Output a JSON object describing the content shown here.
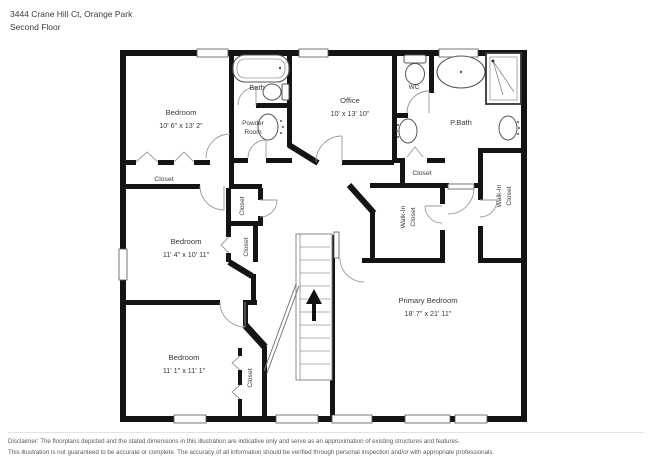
{
  "header": {
    "address": "3444 Crane Hill Ct, Orange Park",
    "floor": "Second Floor"
  },
  "rooms": {
    "bedroom_top": {
      "name": "Bedroom",
      "dims": "10' 6\" x 13' 2\""
    },
    "bedroom_mid": {
      "name": "Bedroom",
      "dims": "11' 4\" x 10' 11\""
    },
    "bedroom_bottom": {
      "name": "Bedroom",
      "dims": "11' 1\" x 11' 1\""
    },
    "primary_bedroom": {
      "name": "Primary Bedroom",
      "dims": "18' 7\" x 21' 11\""
    },
    "office": {
      "name": "Office",
      "dims": "10' x 13' 10\""
    },
    "bath": {
      "name": "Bath"
    },
    "powder_room": {
      "line1": "Powder",
      "line2": "Room"
    },
    "wc": {
      "name": "WC"
    },
    "primary_bath": {
      "name": "P.Bath"
    },
    "closet_label": "Closet",
    "walk_in": {
      "line1": "Walk-In",
      "line2": "Closet"
    }
  },
  "disclaimer": {
    "line1": "Disclaimer: The floorplans depicted and the stated dimensions in this illustration are indicative only and serve as an approximation of existing structures and features.",
    "line2": "This illustration is not guaranteed to be accurate or complete. The accuracy of all information should be verified through personal inspection and/or with appropriate professionals."
  }
}
